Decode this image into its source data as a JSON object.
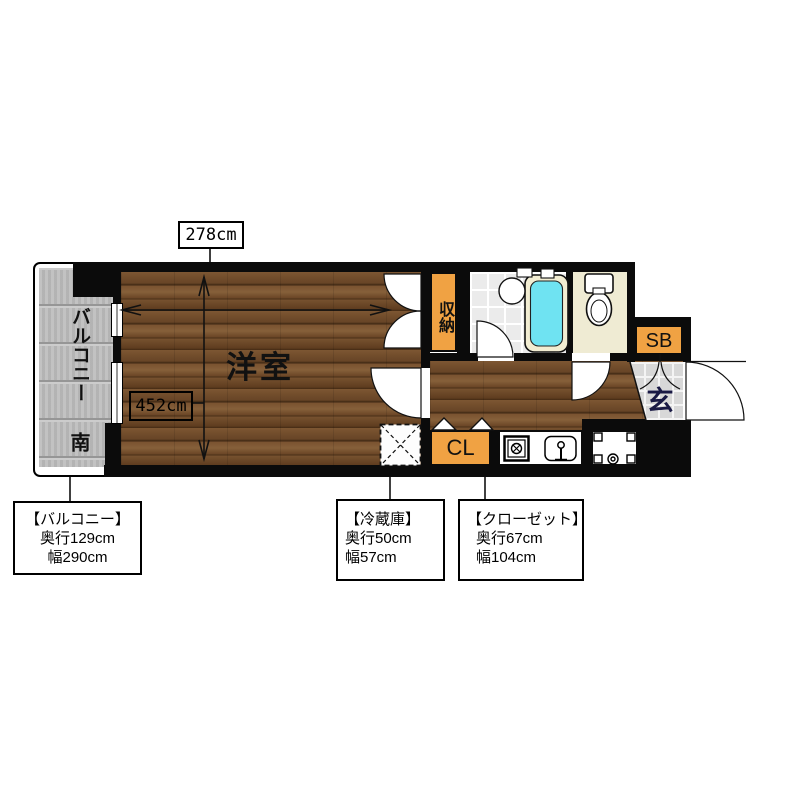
{
  "plan": {
    "room_label": "洋室",
    "balcony_label": "バルコニー",
    "south_label": "南",
    "storage_label": "収納",
    "shoebox_label": "SB",
    "closet_label": "CL",
    "entrance_label": "玄",
    "width_dim": "452cm",
    "depth_dim": "278cm"
  },
  "notes": {
    "balcony": {
      "title": "【バルコニー】",
      "depth": "奥行129cm",
      "width": "幅290cm"
    },
    "fridge": {
      "title": "【冷蔵庫】",
      "depth": "奥行50cm",
      "width": "幅57cm"
    },
    "closet": {
      "title": "【クローゼット】",
      "depth": "奥行67cm",
      "width": "幅104cm"
    }
  },
  "colors": {
    "accent_orange": "#F0A243",
    "bathtub_cyan": "#6FE3F2",
    "wood_brown": "#76512F",
    "balcony_gray": "#BDBDBD",
    "wall_black": "#0B0B0B"
  }
}
